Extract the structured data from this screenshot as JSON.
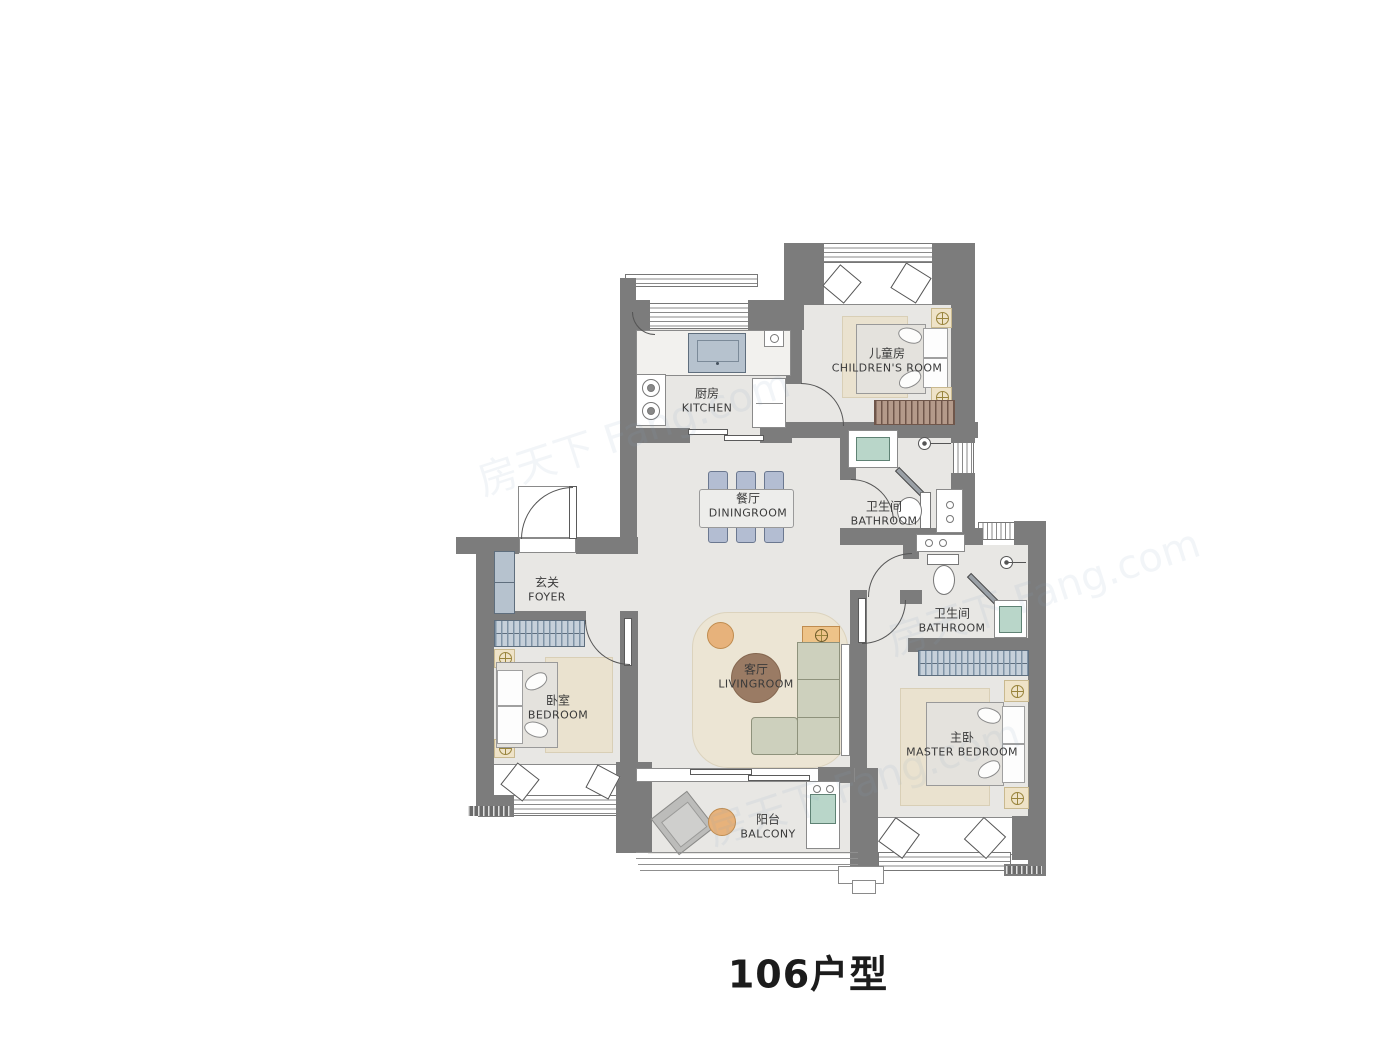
{
  "title": "106户型",
  "watermark": "房天下 Fang.com",
  "rooms": [
    {
      "id": "kitchen",
      "zh": "厨房",
      "en": "KITCHEN"
    },
    {
      "id": "childrens-room",
      "zh": "儿童房",
      "en": "CHILDREN'S ROOM"
    },
    {
      "id": "diningroom",
      "zh": "餐厅",
      "en": "DININGROOM"
    },
    {
      "id": "bathroom-1",
      "zh": "卫生间",
      "en": "BATHROOM"
    },
    {
      "id": "foyer",
      "zh": "玄关",
      "en": "FOYER"
    },
    {
      "id": "bedroom",
      "zh": "卧室",
      "en": "BEDROOM"
    },
    {
      "id": "livingroom",
      "zh": "客厅",
      "en": "LIVINGROOM"
    },
    {
      "id": "bathroom-2",
      "zh": "卫生间",
      "en": "BATHROOM"
    },
    {
      "id": "master-bedroom",
      "zh": "主卧",
      "en": "MASTER BEDROOM"
    },
    {
      "id": "balcony",
      "zh": "阳台",
      "en": "BALCONY"
    }
  ],
  "colors": {
    "wall": "#7c7c7c",
    "floor": "#e8e7e4",
    "rug": "#ece5d4",
    "wood_accent": "#e7b27b",
    "furniture_blue": "#b3bdd2",
    "fixture_teal": "#b9d6c9",
    "sofa": "#cdd0bd",
    "table_brown": "#9a7b64"
  }
}
